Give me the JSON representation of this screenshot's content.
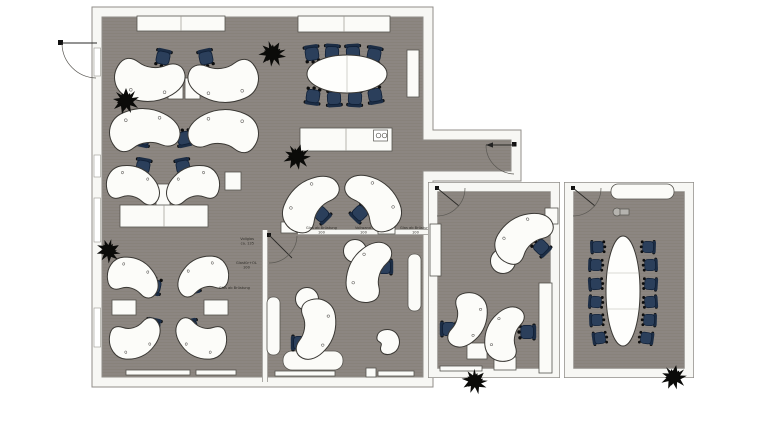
{
  "meta": {
    "type": "office-floor-plan",
    "view": "top-down 2D architectural plan",
    "background": "#ffffff"
  },
  "palette": {
    "floor": "#8c8681",
    "floor_line": "#868078",
    "wall_fill": "#f7f7f4",
    "wall_edge": "#908e89",
    "desk_fill": "#fcfcf9",
    "desk_edge": "#3a3834",
    "chair_seat": "#2b3f5b",
    "chair_back": "#1c2d45",
    "plant": "#0b0b09",
    "label_text": "#2e2c28"
  },
  "labels": [
    {
      "text": "Glas ab Brüstung"
    },
    {
      "text": "100"
    },
    {
      "text": "Vollwand"
    },
    {
      "text": "100"
    },
    {
      "text": "Glas ab Brüstung"
    },
    {
      "text": "100"
    },
    {
      "text": "Vollglas"
    },
    {
      "text": "ca. 135"
    },
    {
      "text": "Glastür+OL"
    },
    {
      "text": "100"
    },
    {
      "text": "Glas ab Brüstung"
    }
  ],
  "icons": [
    {
      "name": "sink-icon",
      "meaning": "kitchenette sink on counter"
    },
    {
      "name": "projector-icon",
      "meaning": "projector in conference room"
    },
    {
      "name": "door-swing-icon",
      "meaning": "door leaf with swing arc"
    },
    {
      "name": "plant-icon",
      "meaning": "potted plant"
    },
    {
      "name": "window",
      "meaning": "glazing segment in wall"
    }
  ],
  "rooms": [
    {
      "name": "open-office-area",
      "desks": 12,
      "task_chairs": 12,
      "meeting_table_seats": 8,
      "kitchenette_counter": 1,
      "cabinets": 2,
      "plants": 4
    },
    {
      "name": "bottom-middle-office",
      "desks": 2,
      "task_chairs": 2,
      "sideboards": 3,
      "stool_tables": 1
    },
    {
      "name": "middle-right-office",
      "desks": 3,
      "task_chairs": 3,
      "sideboards": 2,
      "plants": 1
    },
    {
      "name": "right-conference-room",
      "table_seats": 12,
      "sideboards": 1,
      "plants": 1,
      "projector": 1
    }
  ]
}
